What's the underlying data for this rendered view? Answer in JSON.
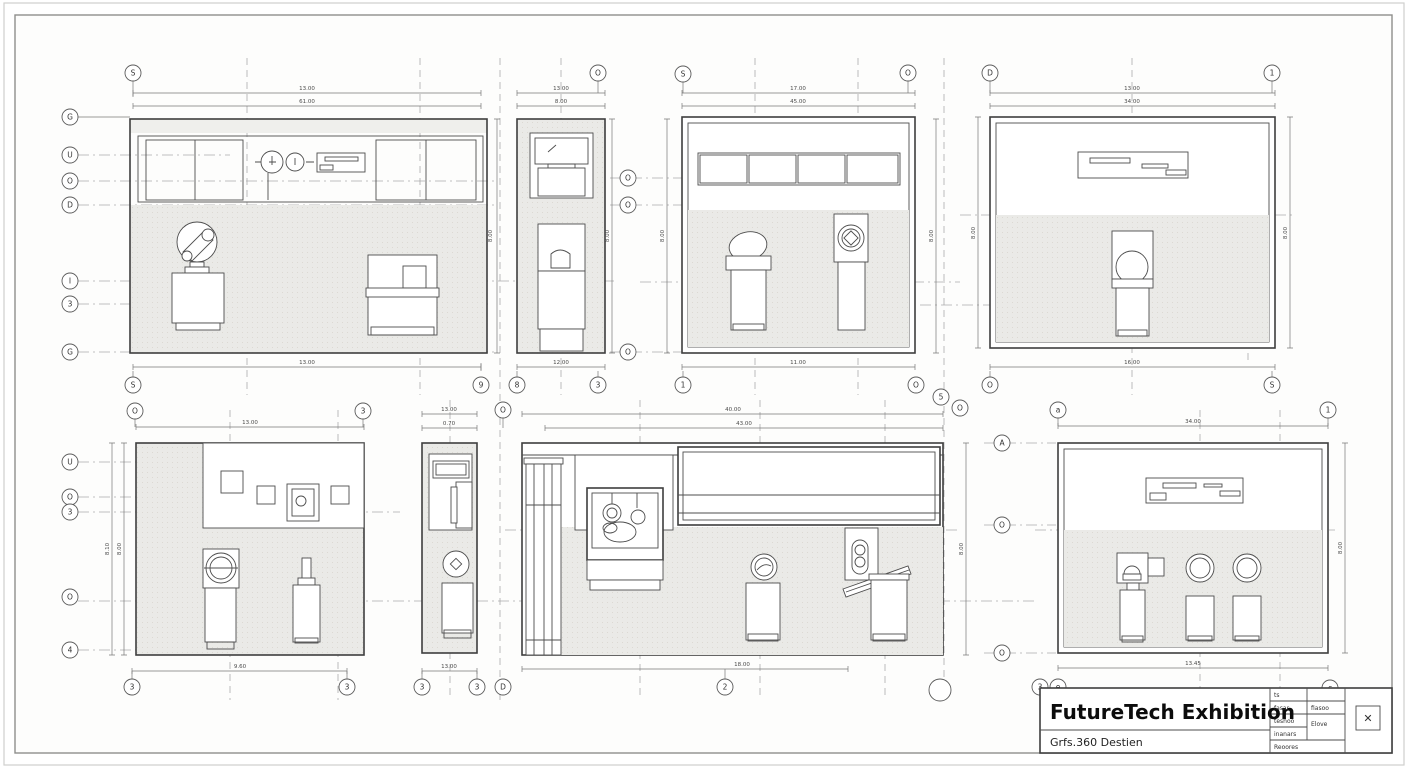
{
  "sheet": {
    "title_block": {
      "title": "FutureTech Exhibition",
      "subtitle": "Grfs.360 Destien",
      "rows": [
        "ts",
        "fasar",
        "teshoo",
        "inanars",
        "Reoores"
      ],
      "col2": [
        "fiasoo",
        "Elove"
      ],
      "stamp_glyph": "✕"
    },
    "colors": {
      "paper": "#fdfdfc",
      "line": "#4b4b4b",
      "fill_gray": "#eaeae7"
    }
  },
  "bubbles": [
    "S",
    "O",
    "S",
    "O",
    "D",
    "1",
    "G",
    "U",
    "O",
    "D",
    "I",
    "3",
    "G",
    "O",
    "O",
    "O",
    "S",
    "9",
    "8",
    "3",
    "1",
    "O",
    "O",
    "S",
    "5",
    "O",
    "O",
    "3",
    "O",
    "a",
    "1",
    "U",
    "O",
    "3",
    "O",
    "4",
    "A",
    "O",
    "O",
    "3",
    "3",
    "3",
    "3",
    "D",
    "2",
    "",
    "3",
    "e",
    "c"
  ],
  "dims": [
    "13.00",
    "61.00",
    "13.00",
    "8.00",
    "13.00",
    "8.00",
    "12.00",
    "8.00",
    "17.00",
    "45.00",
    "11.00",
    "8.00",
    "8.00",
    "13.00",
    "34.00",
    "16.00",
    "8.00",
    "8.00",
    "13.00",
    "9.60",
    "8.10",
    "8.00",
    "13.00",
    "0.70",
    "13.00",
    "40.00",
    "43.00",
    "18.00",
    "8.00",
    "34.00",
    "13.45",
    "8.00"
  ]
}
